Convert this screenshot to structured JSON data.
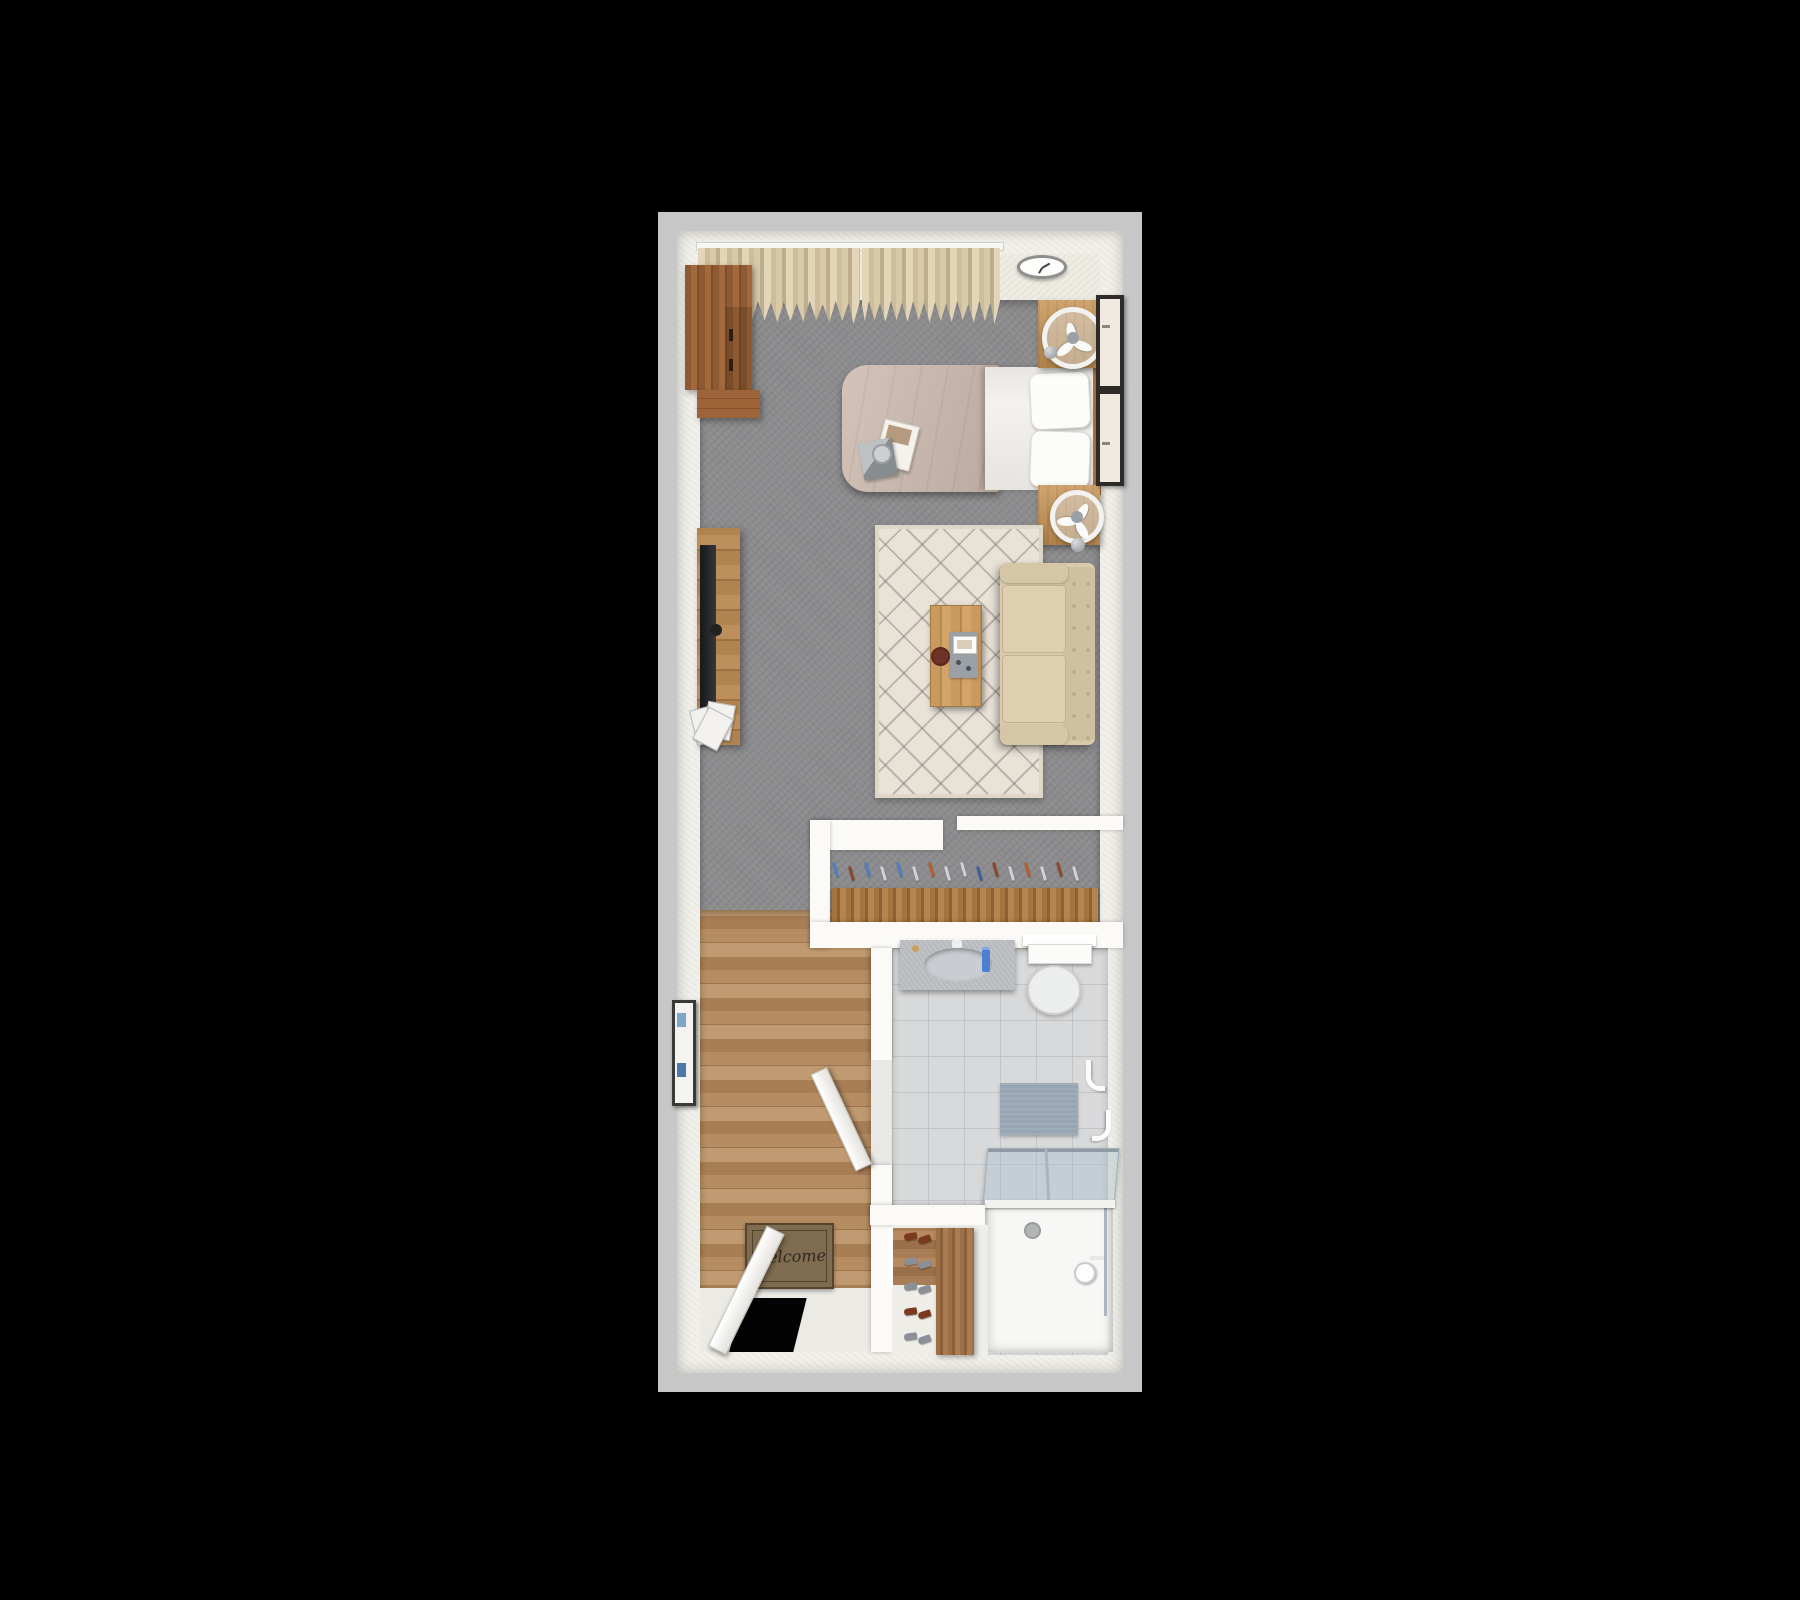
{
  "scene": {
    "description": "3D rendered top-down floor plan of a studio apartment on a black background",
    "background": "#000000"
  },
  "palette": {
    "outer_border": "#c7c7c7",
    "wall": "#f2f0ea",
    "carpet": "#8c8c8e",
    "wood_floor": "#b2855c",
    "tile_floor": "#d8d9da",
    "rug": "#e8e2d7",
    "sofa": "#d9cbab",
    "bed_duvet": "#c9b6aa",
    "bed_linen": "#f4f2ee",
    "curtain": "#d8c9a9",
    "wood_furniture": "#b08350",
    "wood_wardrobe": "#8d5a33",
    "doormat": "#7f6b4f",
    "bath_mat": "#97a6b2",
    "shower_glass": "#aec4d3",
    "accent_blue": "#4a7fd4"
  },
  "rooms": [
    {
      "name": "main-room",
      "floor": "gray carpet"
    },
    {
      "name": "closet",
      "floor": "gray carpet"
    },
    {
      "name": "entry-hall",
      "floor": "wood planks"
    },
    {
      "name": "bathroom",
      "floor": "gray tile"
    }
  ],
  "furniture": [
    "wardrobe",
    "curtains",
    "wall-clock",
    "bed",
    "nightstand-top",
    "nightstand-bottom",
    "table-fan-top",
    "table-fan-bottom",
    "wall-frame-top",
    "wall-frame-bottom",
    "tv-console",
    "tv",
    "magazine-rack",
    "area-rug",
    "coffee-table",
    "serving-tray",
    "loveseat",
    "closet-rod-with-hangers",
    "hall-wall-art",
    "welcome-mat",
    "entry-door",
    "bathroom-door",
    "vanity-sink",
    "toilet",
    "towel-shelf",
    "wall-hooks",
    "bath-mat",
    "shower-stall",
    "shower-glass-door",
    "shoe-rack"
  ],
  "doormat": {
    "text": "Welcome"
  },
  "bed": {
    "accessories": [
      "magazine",
      "gift-box",
      "cup"
    ]
  },
  "closet": {
    "hanger_colors": [
      "#4f7ec2",
      "#8a4a2a",
      "#4f7ec2",
      "#cfd3d6",
      "#4f7ec2",
      "#cfd3d6",
      "#b85c2e",
      "#cfd3d6",
      "#cfd3d6",
      "#3f5f9e",
      "#8a4a2a",
      "#cfd3d6",
      "#b85c2e",
      "#cfd3d6",
      "#8a4a2a",
      "#cfd3d6"
    ]
  },
  "entry": {
    "shoe_colors": [
      "#7b3a20",
      "#8b9096",
      "#8b9096",
      "#7b3a20",
      "#8b9096"
    ]
  }
}
